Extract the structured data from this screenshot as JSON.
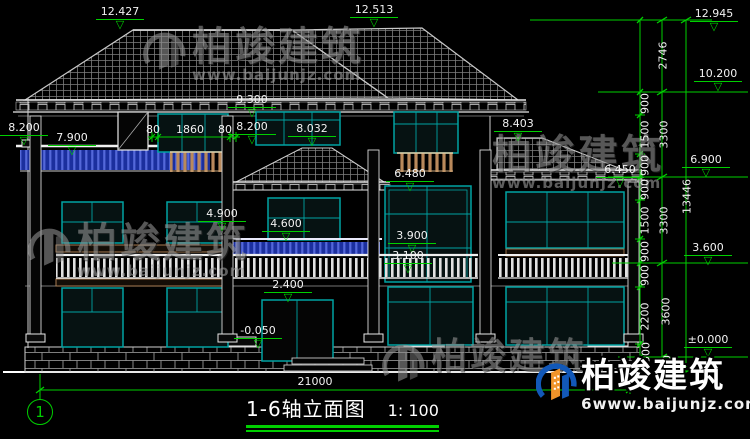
{
  "drawing": {
    "axis_bubble": "1",
    "title": "1-6轴立面图",
    "scale": "1: 100",
    "elevation_labels": {
      "e12427": "12.427",
      "e12513": "12.513",
      "e12945": "12.945",
      "e10200": "10.200",
      "e9300": "9.300",
      "e8200_left": "8.200",
      "e8200_mid": "8.200",
      "e7900": "7.900",
      "e8032": "8.032",
      "e8403": "8.403",
      "e6900": "6.900",
      "e6480": "6.480",
      "e6450": "6.450",
      "e4900": "4.900",
      "e4600": "4.600",
      "e3900": "3.900",
      "e3600": "3.600",
      "e3100": "3.100",
      "e2400": "2.400",
      "e0000": "±0.000",
      "em0050": "-0.050"
    },
    "dimension_labels": {
      "w80a": "80",
      "w1860": "1860",
      "w80b": "80",
      "v2746": "2746",
      "seg900a": "900",
      "seg1500a": "1500",
      "seg900b": "900",
      "seg900c": "900",
      "seg1500b": "1500",
      "seg900d": "900",
      "seg900e": "900",
      "seg2200": "2200",
      "seg500a": "500",
      "seg500b": "500",
      "sub3300a": "3300",
      "sub3300b": "3300",
      "sub3600": "3600",
      "total13446": "13446",
      "overall21000": "21000"
    },
    "watermark": {
      "brand": "柏竣建筑",
      "site": "www.baijunjz.com",
      "site_badge": "6www.baijunjz.com"
    }
  }
}
